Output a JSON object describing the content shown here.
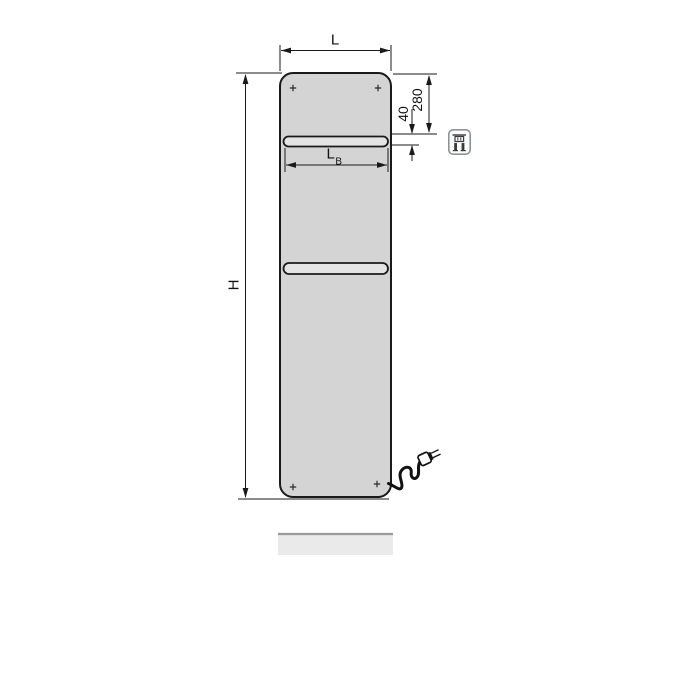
{
  "diagram": {
    "kind": "technical dimension drawing of a flat panel radiator with two towel slots, power cord and plug",
    "dimensions": {
      "width_label": "L",
      "height_label": "H",
      "slot_width_label": "L",
      "slot_width_sub": "B",
      "top_to_slot": "280",
      "slot_height": "40"
    },
    "icons": {
      "badge": "electric-plug-icon"
    },
    "colors": {
      "panel_fill": "#d4d4d4",
      "outline": "#1a1a1a",
      "slot_fill": "#e4e4e4",
      "dim_line": "#1a1a1a",
      "floor_fill": "#eaeaea",
      "floor_edge": "#9a9a9a",
      "icon_border": "#8f9596",
      "background": "#ffffff"
    }
  }
}
